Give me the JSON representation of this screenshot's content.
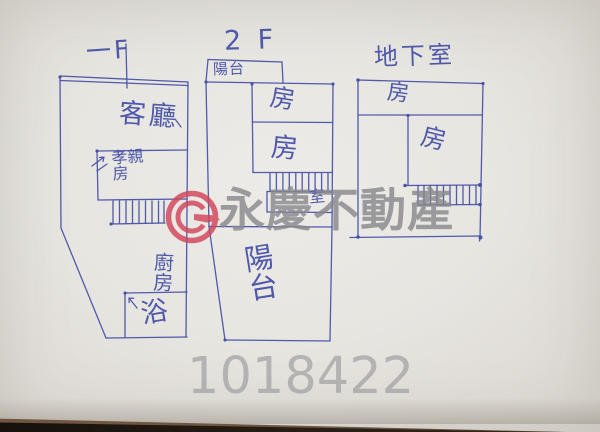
{
  "colors": {
    "pen": "#434da6",
    "wm-red": "#d2445a",
    "wm-gray": "#87878b",
    "serial-gray": "#97979a",
    "paper": "#e8e6e2",
    "table": "#241b13"
  },
  "plans": {
    "floor1": {
      "title": "一F",
      "living_room": "客廳",
      "parents_room": "孝親房",
      "kitchen": "廚房",
      "bath": "浴"
    },
    "floor2": {
      "title": "2 F",
      "upper_balcony": "陽台",
      "room_top": "房",
      "room_mid": "房",
      "small_room": "室",
      "lower_balcony": "陽台"
    },
    "basement": {
      "title": "地下室",
      "room_front": "房",
      "room_main": "房"
    }
  },
  "watermark": {
    "brand_text": "永慶不動產",
    "logo": "yungching-ring-logo"
  },
  "serial_number": "1018422"
}
